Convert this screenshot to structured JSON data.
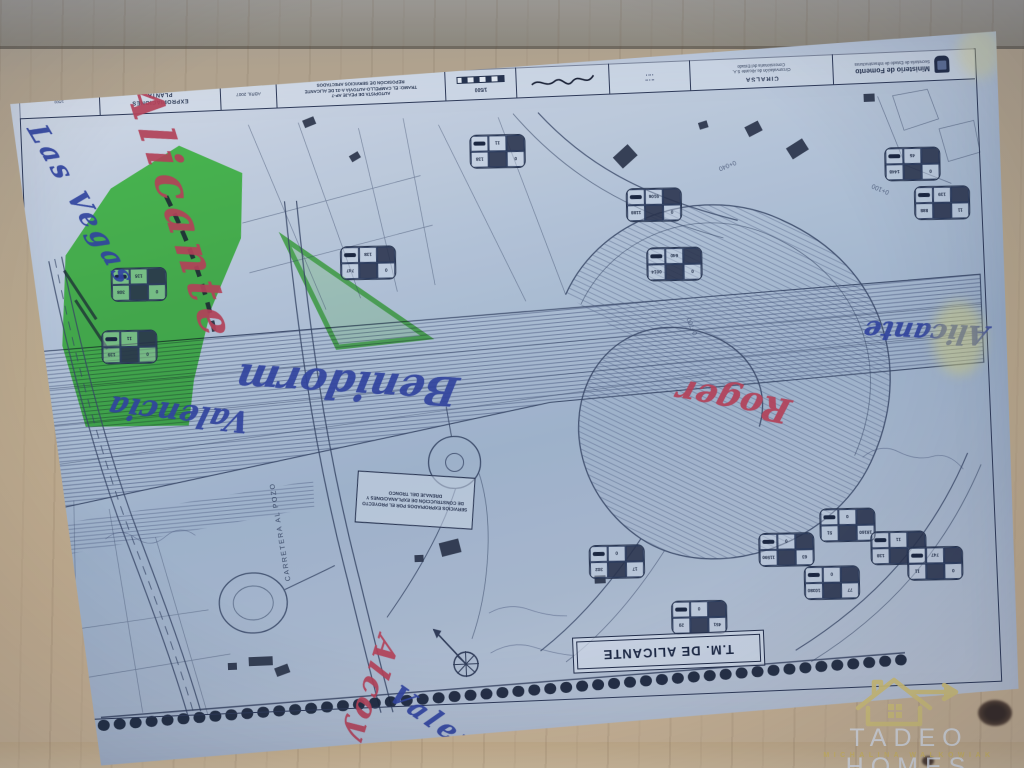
{
  "titleblock": {
    "ministry": "Ministerio de Fomento",
    "ministry_sub": "Secretaría de Estado de Infraestructuras",
    "company": "CIRALSA",
    "company_sub1": "Circunvalación de Alicante S.A.",
    "company_sub2": "Concesionaria del Estado",
    "project_line1": "AUTOPISTA DE PEAJE AP-7",
    "project_line2": "TRAMO: EL CAMPELLO-AUTOVÍA A-31 DE ALICANTE",
    "project_line3": "REPOSICIÓN DE SERVICIOS AFECTADOS",
    "sheet_title1": "EXPROPIACIONES",
    "sheet_title2": "PLANTA",
    "date": "ABRIL 2007",
    "scale": "1/500",
    "crest_icon": "ministry-crest-icon"
  },
  "map": {
    "municipality_label": "T.M. DE ALICANTE",
    "road_label": "CARRETERA AL POZO",
    "services_note": "SERVICIOS EXPROPIADOS POR EL PROYECTO DE CONSTRUCCIÓN DE EXPLANACIONES Y DRENAJE DEL TRONCO",
    "stations": [
      "0+040",
      "0+100",
      "0+700"
    ],
    "highlight_color": "#36d22e"
  },
  "annotations": [
    {
      "text": "Alicante",
      "color": "#b63a50",
      "pen": "red"
    },
    {
      "text": "Las Vegas",
      "color": "#2a3c9b",
      "pen": "blue"
    },
    {
      "text": "Benidorm",
      "color": "#2a3c9b",
      "pen": "blue"
    },
    {
      "text": "Valencia",
      "color": "#2a3c9b",
      "pen": "blue"
    },
    {
      "text": "Roger",
      "color": "#b63a50",
      "pen": "red"
    },
    {
      "text": "Alicante",
      "color": "#2a3c9b",
      "pen": "blue"
    },
    {
      "text": "Alcoy",
      "color": "#b63a50",
      "pen": "red"
    },
    {
      "text": "Valencia",
      "color": "#2a3c9b",
      "pen": "blue"
    }
  ],
  "parcel_boxes": [
    [
      "0",
      "138",
      "11"
    ],
    [
      "0",
      "747",
      "138"
    ],
    [
      "0",
      "1188",
      "9106"
    ],
    [
      "0",
      "0014",
      "640"
    ],
    [
      "0",
      "1448",
      "45"
    ],
    [
      "11",
      "888",
      "139"
    ],
    [
      "0",
      "308",
      "135"
    ],
    [
      "0",
      "139",
      "11"
    ],
    [
      "17",
      "302",
      "0"
    ],
    [
      "451",
      "20",
      "0"
    ],
    [
      "63",
      "11590",
      "0"
    ],
    [
      "18160",
      "51",
      "0"
    ],
    [
      "77",
      "10380",
      "0"
    ],
    [
      "0",
      "138",
      "11"
    ],
    [
      "0",
      "11",
      "747"
    ]
  ],
  "watermark": {
    "title": "TADEO HOMES",
    "subtitle": "MICHALINA WALKOWIAK",
    "icon": "house-arrow-icon",
    "accent": "#d8c474"
  }
}
